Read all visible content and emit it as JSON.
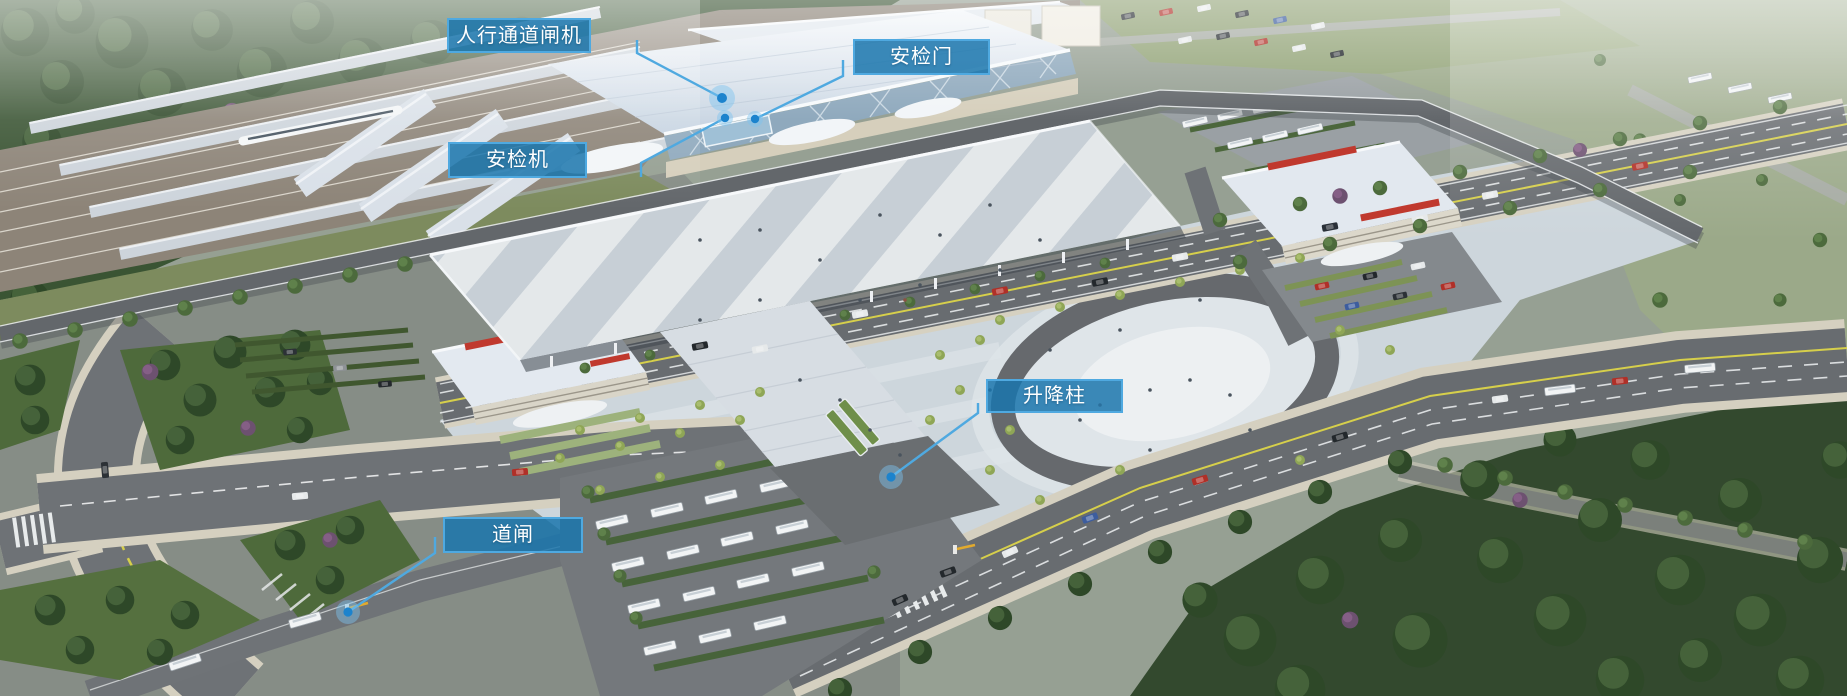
{
  "labels": [
    {
      "id": "pedestrian-gate",
      "text": "人行通道闸机"
    },
    {
      "id": "security-door",
      "text": "安检门"
    },
    {
      "id": "security-scanner",
      "text": "安检机"
    },
    {
      "id": "bollard",
      "text": "升降柱"
    },
    {
      "id": "barrier-gate",
      "text": "道闸"
    }
  ],
  "colors": {
    "label_fill": "rgba(26,117,173,0.85)",
    "label_border": "#4fa9e0",
    "leader": "#4fa9e0",
    "dot": "#1c83cd",
    "dot_halo": "rgba(125,195,240,0.45)"
  }
}
